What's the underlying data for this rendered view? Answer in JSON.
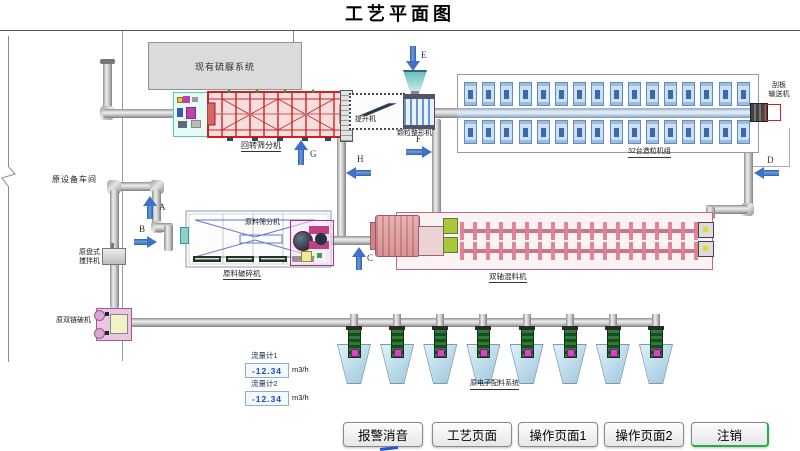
{
  "title": "工艺平面图",
  "labels": {
    "existing_system": "现有硫脲系统",
    "rotary_screen": "回转筛分机",
    "elevator": "提升机",
    "granule_shaper": "颗粒整形机",
    "granulator_group": "32台造粒机组",
    "scraper_conveyor": [
      "刮板",
      "输送机"
    ],
    "workshop": "原设备车间",
    "disc_mixer": [
      "原盘式",
      "搅拌机"
    ],
    "chain_crusher": "原双链破机",
    "raw_screen": "原料筛分机",
    "raw_crusher": "原料破碎机",
    "twin_mixer": "双轴混料机",
    "batching_system": "原电子配料系统"
  },
  "flow_arrows": {
    "a": "A",
    "b": "B",
    "c": "C",
    "d": "D",
    "e": "E",
    "f": "F",
    "g": "G",
    "h": "H"
  },
  "flow_meters": [
    {
      "label": "流量计1",
      "value": "-12.34",
      "unit": "m3/h"
    },
    {
      "label": "流量计2",
      "value": "-12.34",
      "unit": "m3/h"
    }
  ],
  "buttons": [
    {
      "label": "报警消音"
    },
    {
      "label": "工艺页面"
    },
    {
      "label": "操作页面1"
    },
    {
      "label": "操作页面2"
    },
    {
      "label": "注销"
    }
  ],
  "counts": {
    "granulator_columns": 16,
    "hoppers": 8
  },
  "colors": {
    "arrow_blue": "#3E72C6",
    "machine_red": "#CC2222",
    "logout_green": "#1FB141",
    "meter_text": "#2244BB"
  }
}
